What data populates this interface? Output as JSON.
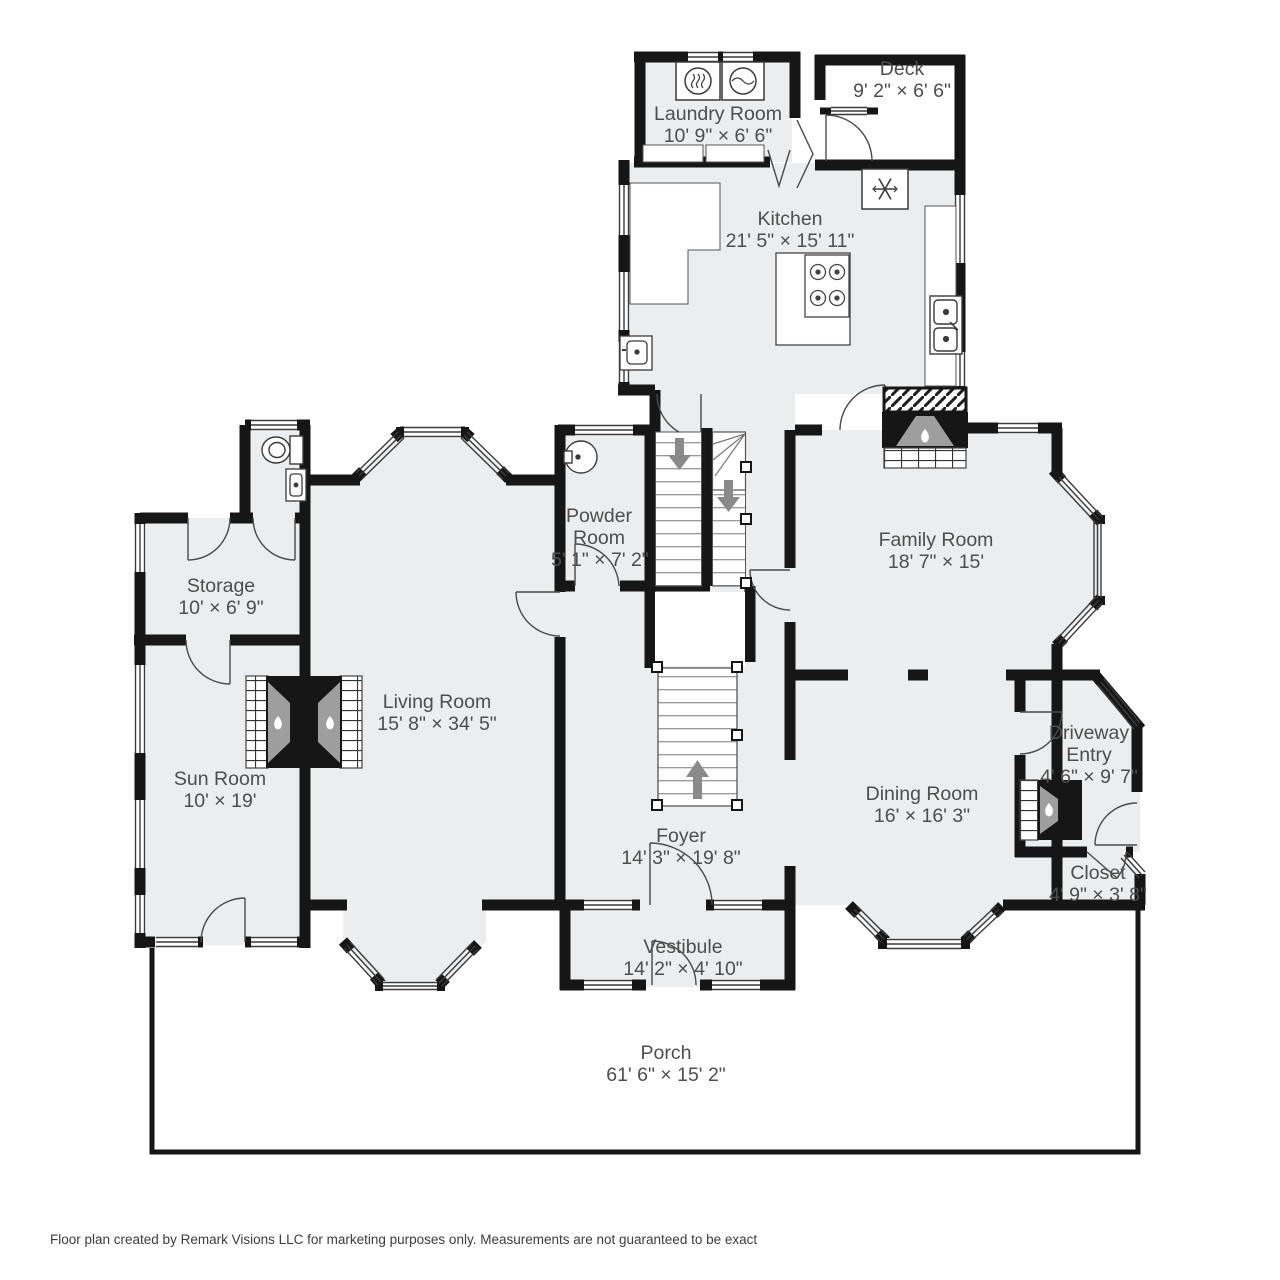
{
  "rooms": {
    "deck": {
      "name": "Deck",
      "dims": "9' 2\" × 6' 6\""
    },
    "laundry": {
      "name": "Laundry Room",
      "dims": "10' 9\" × 6' 6\""
    },
    "kitchen": {
      "name": "Kitchen",
      "dims": "21' 5\" × 15' 11\""
    },
    "powder": {
      "name": "Powder Room",
      "dims": "5' 1\" × 7' 2\""
    },
    "family": {
      "name": "Family Room",
      "dims": "18' 7\" × 15'"
    },
    "storage": {
      "name": "Storage",
      "dims": "10' × 6' 9\""
    },
    "living": {
      "name": "Living Room",
      "dims": "15' 8\" × 34' 5\""
    },
    "sun": {
      "name": "Sun Room",
      "dims": "10' × 19'"
    },
    "driveway": {
      "name": "Driveway Entry",
      "dims": "4' 6\" × 9' 7\""
    },
    "dining": {
      "name": "Dining Room",
      "dims": "16' × 16' 3\""
    },
    "closet": {
      "name": "Closet",
      "dims": "4' 9\" × 3' 8\""
    },
    "foyer": {
      "name": "Foyer",
      "dims": "14' 3\" × 19' 8\""
    },
    "vestibule": {
      "name": "Vestibule",
      "dims": "14' 2\" × 4' 10\""
    },
    "porch": {
      "name": "Porch",
      "dims": "61' 6\" × 15' 2\""
    }
  },
  "fixtures": [
    "dryer-icon",
    "washer-icon",
    "refrigerator-icon",
    "stove-icon",
    "kitchen-sink-icon",
    "prep-sink-icon",
    "powder-sink-icon",
    "toilet-icon",
    "bathroom-sink-icon",
    "fireplace-flame-icon",
    "stairs-up-arrow-icon",
    "stairs-down-arrow-icon"
  ],
  "colors": {
    "wall": "#161616",
    "floor": "#ebedee",
    "fixture_gray": "#9e9e9e",
    "arrow_gray": "#8a8a8a",
    "label": "#4e4e4e"
  },
  "footer": "Floor plan created by Remark Visions LLC for marketing purposes only. Measurements are not guaranteed to be exact"
}
